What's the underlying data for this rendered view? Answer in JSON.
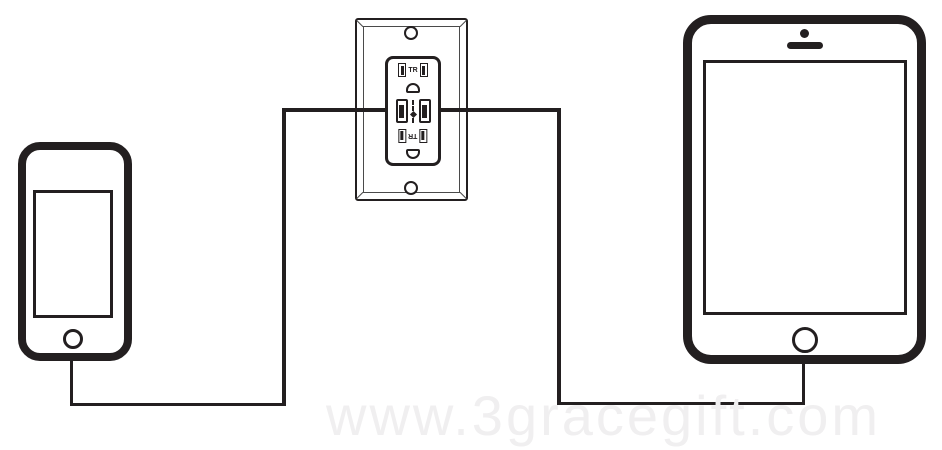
{
  "scene": {
    "colors": {
      "background": "#ffffff",
      "line": "#231f20",
      "bevel": "#4a4a4a",
      "watermark": "#f0eff0"
    },
    "watermark_text": "www.3gracegift.com",
    "outlet": {
      "tr_label": "TR"
    },
    "devices": {
      "left": "smartphone",
      "center": "usb-wall-outlet-charger",
      "right": "tablet"
    }
  }
}
